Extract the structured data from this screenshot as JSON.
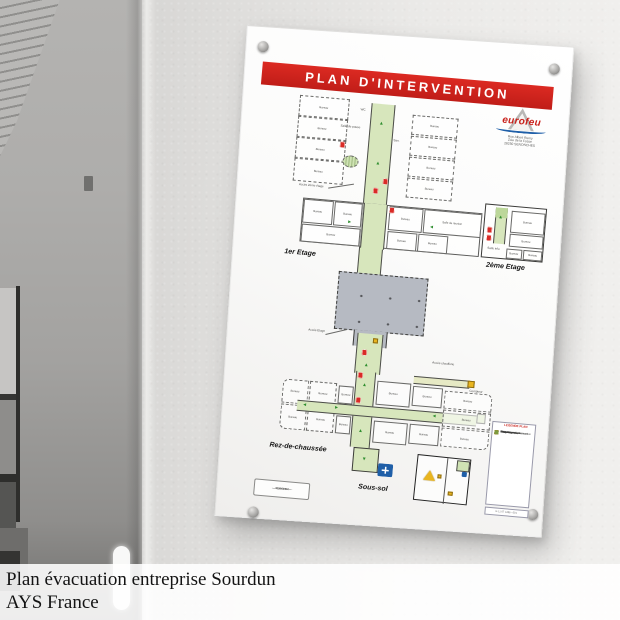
{
  "caption": {
    "line1": "Plan évacuation entreprise Sourdun",
    "line2": "AYS France"
  },
  "board": {
    "title": "PLAN D'INTERVENTION",
    "logo": {
      "name": "eurofeu",
      "address_lines": [
        "Rue Albert Remy",
        "ZAe de la Fosse",
        "28250 SENONCHES"
      ]
    },
    "floor_labels": {
      "floor1": "1er Etage",
      "floor2": "2ème Etage",
      "rdc": "Rez-de-chaussée",
      "sousol": "Sous-sol"
    },
    "legend": {
      "title": "LEGENDE PLAN",
      "footer": "G 11 07 1286 - 001",
      "items": [
        {
          "color": "#4aa23c",
          "label": "Cheminement d'évacuation"
        },
        {
          "color": "#2f8f4e",
          "label": "Sortie de secours"
        },
        {
          "color": "#d92b26",
          "label": "Extincteur"
        },
        {
          "color": "#d92b26",
          "label": "R.I.A."
        },
        {
          "color": "#d92b26",
          "label": "Alarme incendie"
        },
        {
          "color": "#1f5fa8",
          "label": "Point de rassemblement"
        },
        {
          "color": "#e9b51f",
          "label": "Danger spécifique"
        },
        {
          "color": "#e9b51f",
          "label": "Local technique"
        },
        {
          "color": "#a8651f",
          "label": "Coupure gaz"
        },
        {
          "color": "#7c9a3d",
          "label": "Vous êtes ici"
        }
      ]
    },
    "cartouche_lines": [
      "EUROFEU",
      "Services",
      "000 000 000"
    ]
  },
  "strings": {
    "bureau": "Bureau",
    "salle_reunion": "Salle de réunion",
    "salle_pause": "Salle de pause",
    "salle_info": "Salle info",
    "san": "San.",
    "wc": "WC",
    "acces_2eme": "Accès 2ème étage",
    "acces_etage": "Accès Etage",
    "acces_chaufferie": "Accès chaufferie",
    "compteur": "Compteur"
  },
  "colors": {
    "banner": "#d0251f",
    "corridor": "#d7e6bc",
    "hall": "#b6bac2",
    "extinguisher": "#d92b26",
    "assembly": "#1f5fa8",
    "warning": "#e9b51f"
  }
}
